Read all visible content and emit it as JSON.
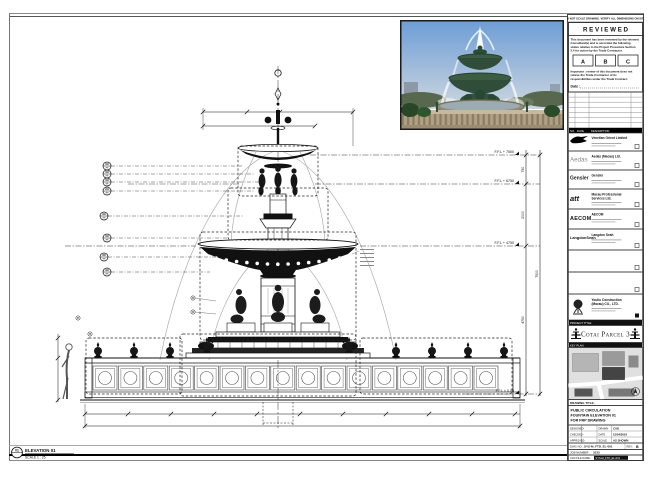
{
  "strip_note": "DO NOT SCALE DRAWING. VERIFY ALL DIMENSIONS ON SITE.",
  "stamp": {
    "title": "R E V I E W E D",
    "l1": "This document has been reviewed by the relevant",
    "l2": "Consultant(s) and is accorded the following",
    "l3": "status relative to the Project Procedure Section",
    "l4": "5.4 for action by the Trade Contractor.",
    "a": "A",
    "b": "B",
    "c": "C",
    "n1": "Important : review of this document does not",
    "n2": "relieve the Trade Contractor of its",
    "n3": "responsibilities under the Trade Contract.",
    "date_label": "Date :"
  },
  "rev_header": {
    "no": "NO.",
    "date": "DATE",
    "desc": "DESCRIPTION"
  },
  "consultants": [
    {
      "logo": "",
      "name1": "Venetian Orient Limited",
      "name2": ""
    },
    {
      "logo": "Aedas",
      "name1": "Aedas (Macau) Ltd.",
      "name2": ""
    },
    {
      "logo": "Gensler",
      "name1": "Gensler",
      "name2": ""
    },
    {
      "logo": "att",
      "name1": "Macau Professional",
      "name2": "Services Ltd."
    },
    {
      "logo": "AECOM",
      "name1": "AECOM",
      "name2": ""
    },
    {
      "logo": "LangdonSeah",
      "name1": "Langdon Seah",
      "name2": ""
    }
  ],
  "contractor": {
    "name1": "Youlio Construction",
    "name2": "(Macau) CO., LTD."
  },
  "project": {
    "band": "PROJECT TITLE",
    "name": "Cotai Parcel 3"
  },
  "keyplan": {
    "band": "KEY PLAN"
  },
  "drawing_title": {
    "label": "DRAWING TITLE:",
    "l1": "PUBLIC CIRCULATION",
    "l2": "FOUNTAIN ELEVATION 01",
    "l3": "FOR FRP DRAWING"
  },
  "meta": {
    "r1c1": "DESIGNED",
    "r1c2": "-",
    "r1c3": "DRAWN",
    "r1c4": "CAD",
    "r2c1": "CHECKED",
    "r2c2": "-",
    "r2c3": "DATE",
    "r2c4": "12/04/2016",
    "r3c1": "APPROVED",
    "r3c2": "-",
    "r3c3": "SCALE",
    "r3c4": "AS SHOWN"
  },
  "dwg": {
    "label": "DWG NO. :",
    "value": "SYS-M_FTD_EL-001",
    "rev_label": "REV :",
    "rev": "B"
  },
  "job": {
    "label": "JOB NUMBER :",
    "value": "3133"
  },
  "cad": {
    "label": "CAD FILE NAME :",
    "value": "SYS-M_FTD_EL-001"
  },
  "drawing": {
    "levels": [
      "F.F.L + 7500",
      "F.F.L + 6750",
      "F.F.L + 4750",
      "F.F.L ± 0.00"
    ],
    "vdims": [
      "750",
      "2000",
      "4750",
      "7500"
    ],
    "elevation": {
      "bubble": "01",
      "title": "ELEVATION 01",
      "scale": "SCALE 1 : 25"
    }
  }
}
